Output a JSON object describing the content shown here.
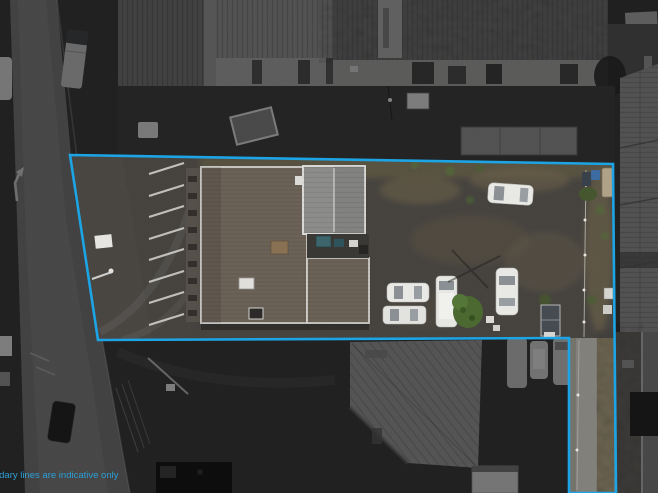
{
  "image": {
    "kind": "aerial-drone-photo",
    "description": "Top-down aerial photo of a commercial property outlined in blue; area outside the boundary is dimmed greyscale",
    "width": 658,
    "height": 493
  },
  "overlay": {
    "disclaimer": "boundary lines are indicative only",
    "disclaimer_color": "#2d9fd6",
    "boundary_color": "#1ca4e4",
    "boundary_points": "70,155 613,164 616,493 569,493 569,338 98,340"
  },
  "colors": {
    "asphalt_inside": "#474440",
    "asphalt_outside": "#3a3a3a",
    "roof_main_brown": "#6f655a",
    "roof_grey_metal": "#8e8e8c",
    "street": "#6f6f6f",
    "warehouse_roof": "#8a8a8a",
    "vegetation_olive": "#6b6450",
    "bush_green": "#4c6a31",
    "car_white": "#ebebe8",
    "parking_stripe": "#d9d9d6",
    "lane_concrete": "#75746d"
  },
  "scene": {
    "inside_boundary": [
      "angled parking bays (8 white stripes)",
      "large brown-roofed building",
      "grey metal roof section with centre ridge",
      "rear yard with five white vehicles",
      "green shrub",
      "small dark shed",
      "fenced side lane running to bottom of frame"
    ],
    "outside_boundary": [
      "street with parked truck and cars (left)",
      "corrugated warehouse rooftops (top)",
      "warehouse roof (right)",
      "angled warehouse roof (bottom centre)",
      "three parked vans (bottom)",
      "white container (bottom)"
    ]
  }
}
